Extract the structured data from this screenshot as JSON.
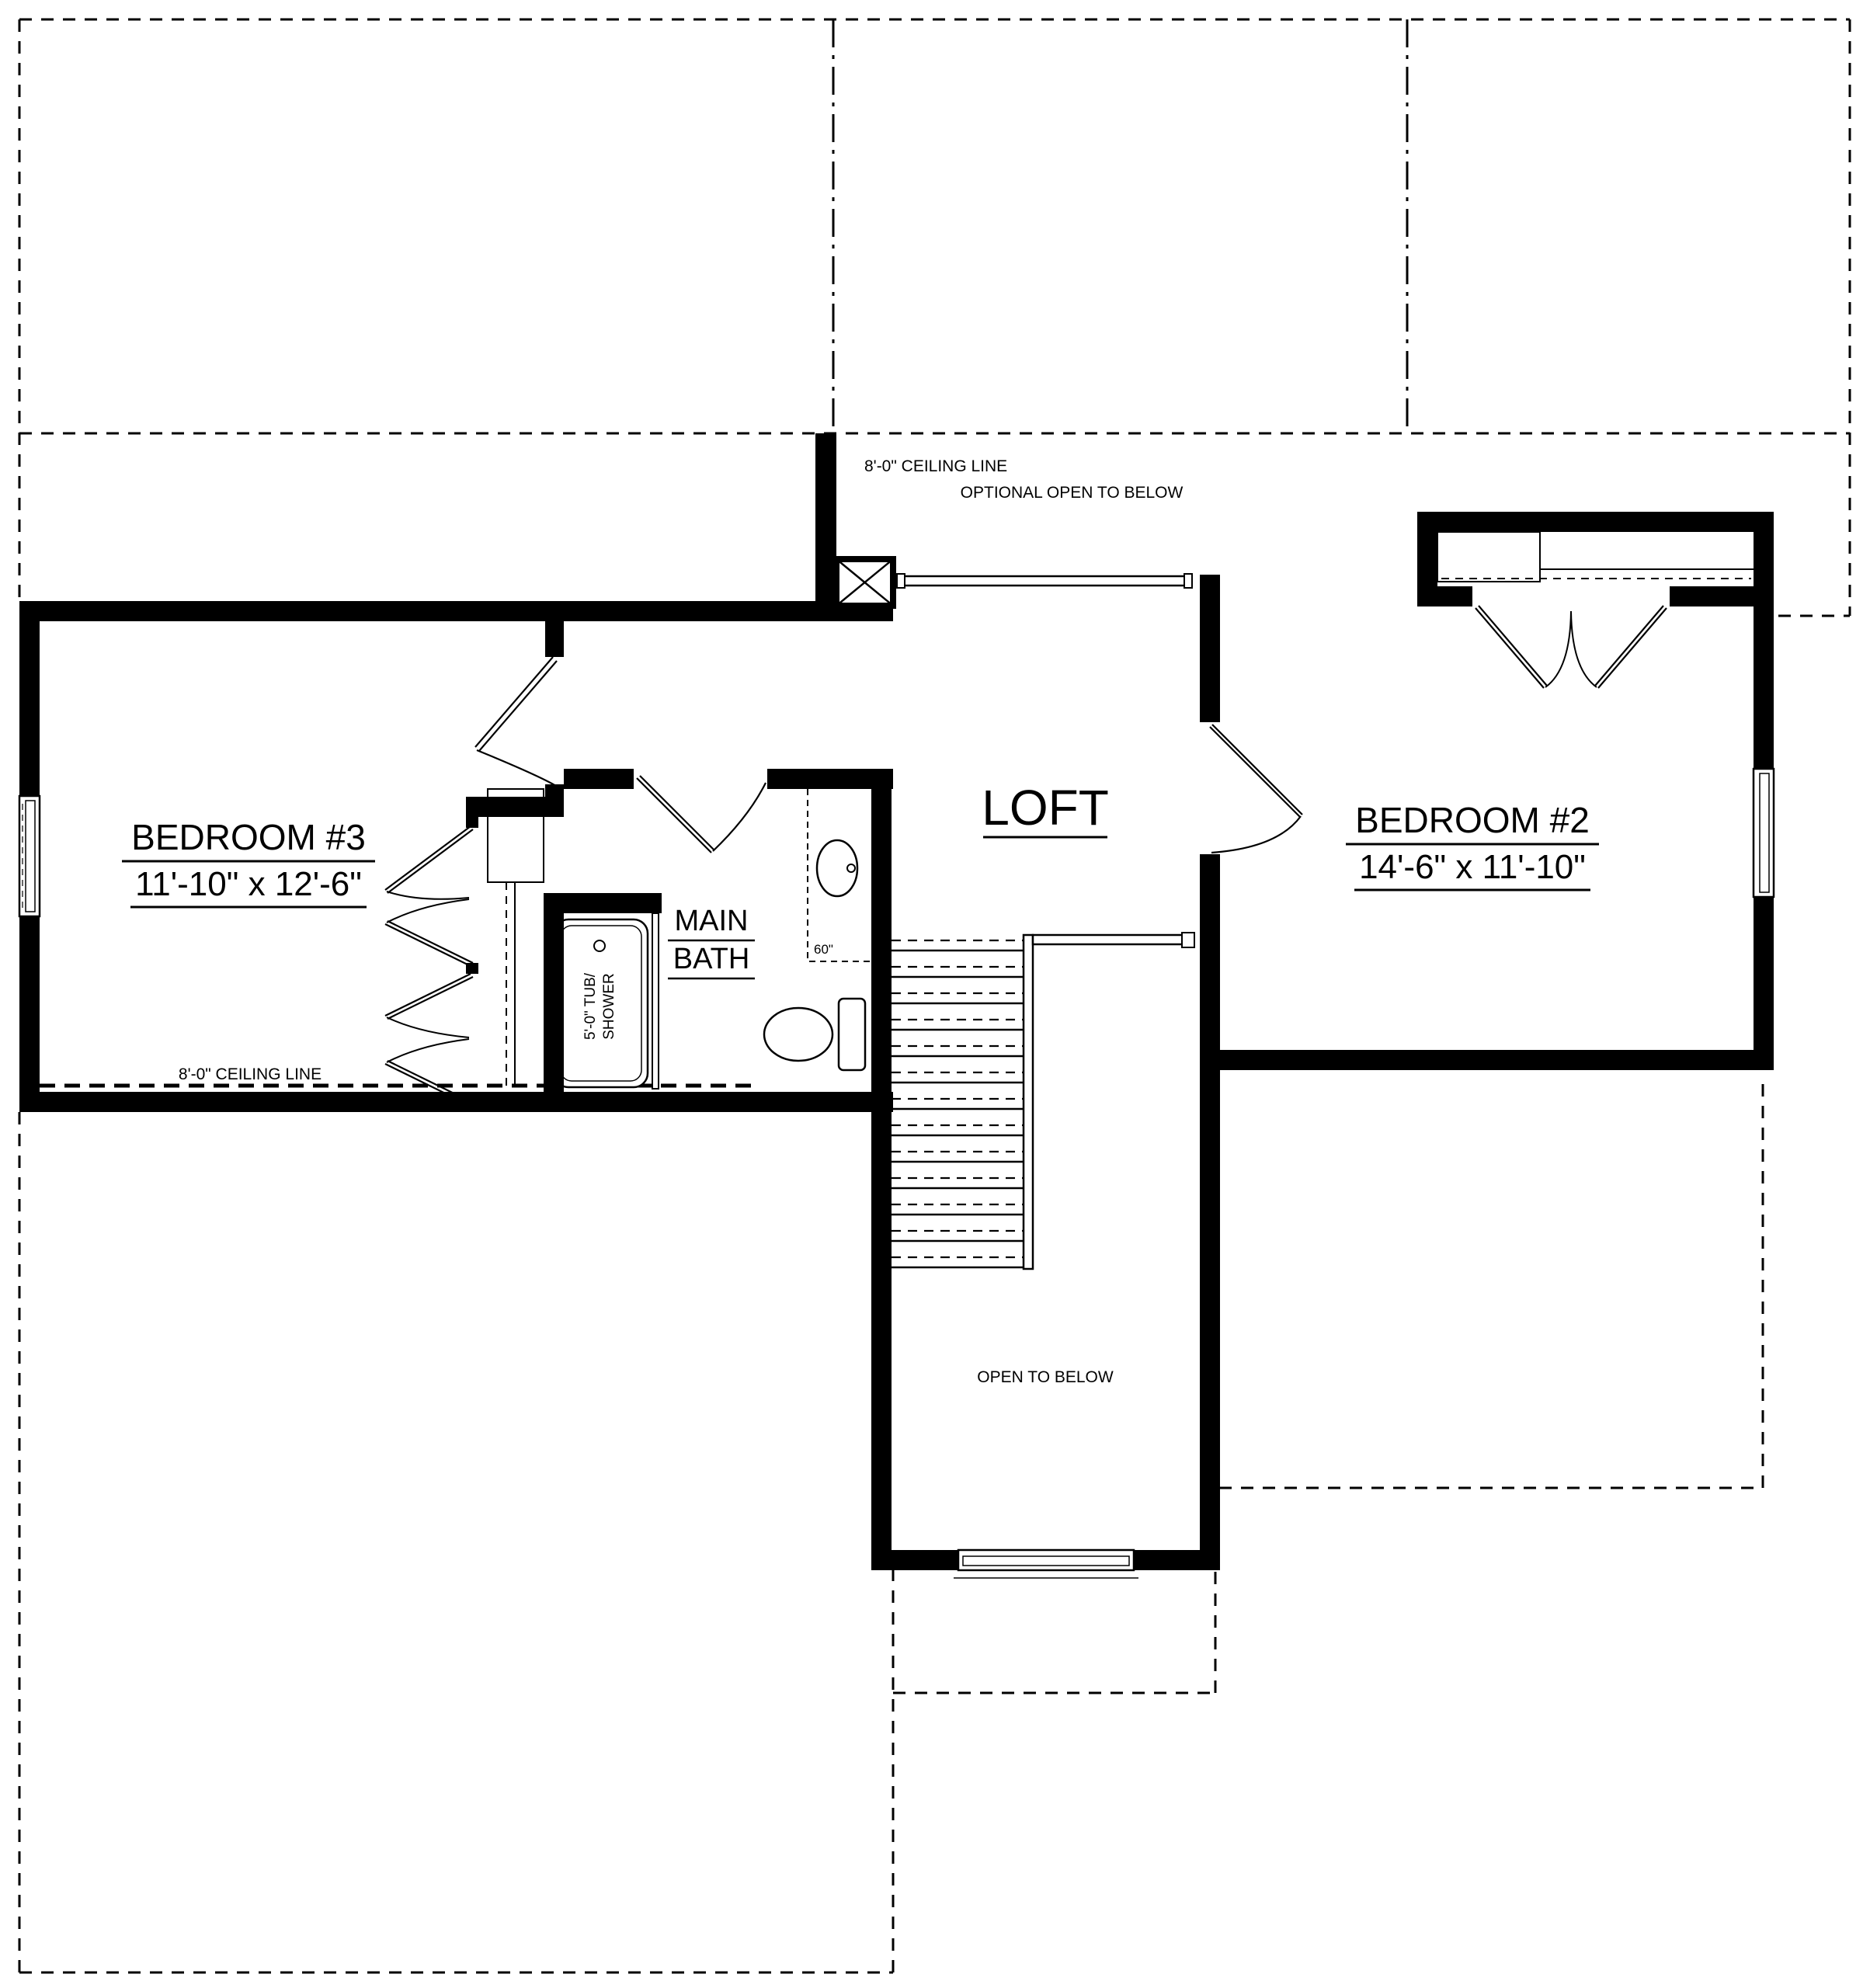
{
  "drawing": {
    "type": "floor-plan",
    "floor": "second-floor",
    "ink_color": "#000000",
    "paper_color": "#ffffff"
  },
  "rooms": {
    "bedroom3": {
      "name": "BEDROOM #3",
      "dims": "11'-10\" x 12'-6\""
    },
    "bedroom2": {
      "name": "BEDROOM #2",
      "dims": "14'-6\" x 11'-10\""
    },
    "loft": {
      "name": "LOFT"
    },
    "main_bath": {
      "line1": "MAIN",
      "line2": "BATH"
    }
  },
  "fixtures": {
    "tub": {
      "line1": "5'-0\" TUB/",
      "line2": "SHOWER"
    },
    "vanity_width": "60\""
  },
  "annotations": {
    "ceiling_line_top": "8'-0\" CEILING LINE",
    "ceiling_line_left": "8'-0\" CEILING LINE",
    "optional_open_to_below": "OPTIONAL OPEN TO BELOW",
    "open_to_below": "OPEN TO BELOW"
  }
}
